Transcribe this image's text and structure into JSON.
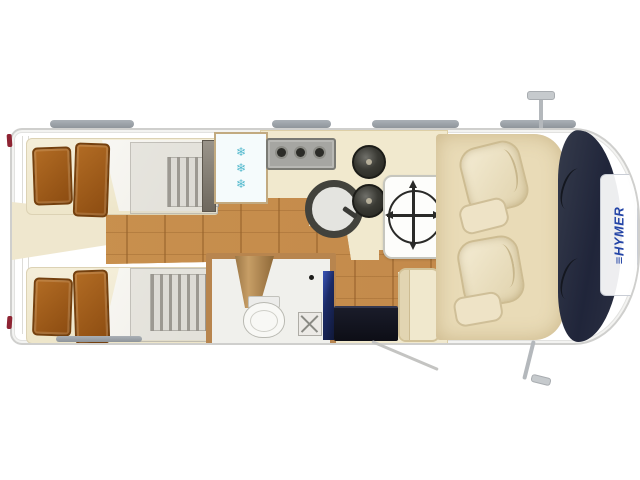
{
  "branding": {
    "mark": "≡",
    "name": "HYMER",
    "logo_color": "#2243a6"
  },
  "symbols": {
    "snowflake": "❄"
  },
  "layout_counts": {
    "single_beds": 2,
    "pillows_per_bed": 2,
    "wardrobes": 2,
    "fridge_snowflakes": 3,
    "stove_knobs": 3,
    "hob_burners": 2,
    "cab_seats": 2,
    "roof_rails": 4,
    "mirrors": 2
  },
  "colors": {
    "background": "#ffffff",
    "body_outline": "#cfcfcd",
    "wood_floor": "#c68f4d",
    "mattress": "#f3ecd6",
    "pillow_brown": "#9e5716",
    "duvet": "#f6f4ef",
    "wardrobe_gray": "#d8d6d0",
    "kitchen_counter": "#f1e9ce",
    "fridge_snowflake_blue": "#55bace",
    "stove_gray": "#a6a6a2",
    "sink_ring": "#42423c",
    "bathroom_wall_tan": "#b8854e",
    "bathroom_floor": "#f0f0ec",
    "cabinet_blue": "#2c3f8f",
    "entry_step_dark": "#14151f",
    "table_white": "#fdfdfb",
    "bench_cream": "#f0e8cd",
    "cab_mat": "#e9dbb7",
    "seat_cream": "#f1e8ce",
    "windshield_dark": "#252a38",
    "taillight_red": "#8e2433",
    "rail_gray": "#9aa0a6"
  }
}
